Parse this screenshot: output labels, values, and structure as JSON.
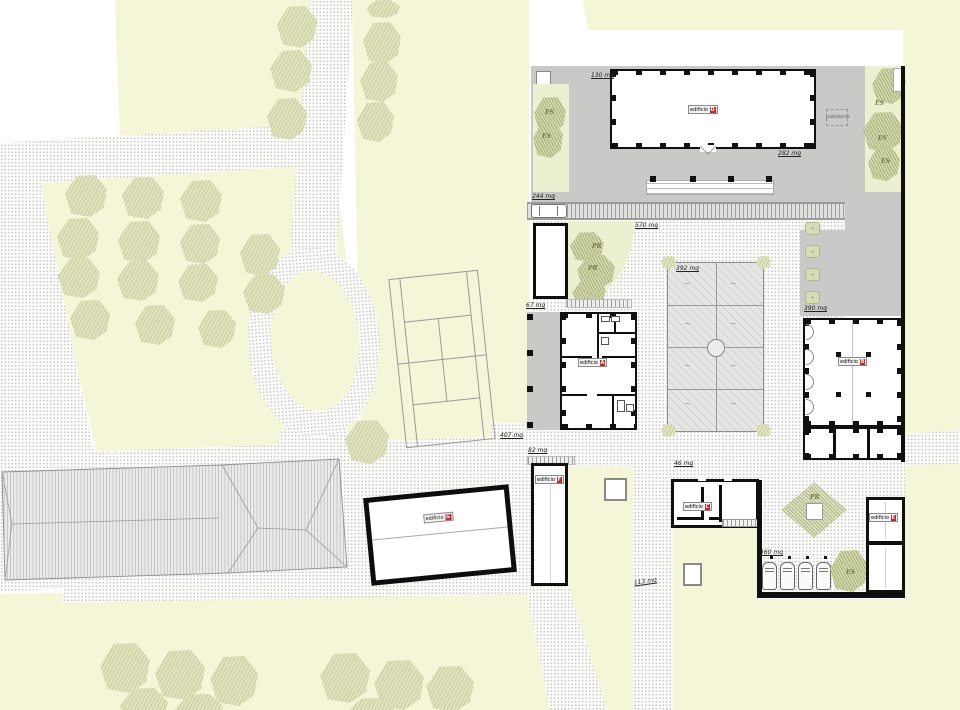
{
  "plan": {
    "areas": {
      "a130": "130 mq",
      "a282": "282 mq",
      "a244": "244 mq",
      "a570": "570 mq",
      "a392": "392 mq",
      "a390": "390 mq",
      "a67": "67 mq",
      "a407": "407 mq",
      "a82": "82 mq",
      "a46": "46 mq",
      "a360": "360 mq",
      "a113": "113 mq"
    },
    "buildings": {
      "a": {
        "name": "edificio",
        "letter": "A"
      },
      "b": {
        "name": "edificio",
        "letter": "B"
      },
      "c": {
        "name": "edificio",
        "letter": "C"
      },
      "d": {
        "name": "edificio",
        "letter": "D"
      },
      "e": {
        "name": "edificio",
        "letter": "E"
      },
      "f": {
        "name": "edificio",
        "letter": "F"
      },
      "g": {
        "name": "edificio",
        "letter": "G"
      }
    },
    "markers": {
      "es": "ES",
      "pr": "PR",
      "platform": "piattaforma"
    },
    "colors": {
      "paving_gray": "#c9c9c7",
      "field_yellow": "#f5f5d8",
      "tree_green": "#e0e3bd",
      "label_red": "#c42424",
      "wall_black": "#0f0f0f"
    }
  }
}
